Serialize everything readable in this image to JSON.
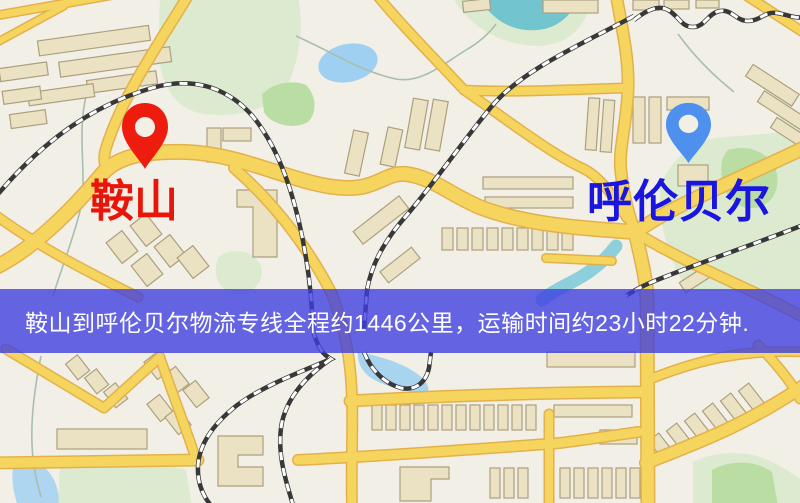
{
  "map": {
    "origin": {
      "name": "鞍山",
      "marker_color": "#ee1c0f",
      "label_color": "#e8150a"
    },
    "destination": {
      "name": "呼伦贝尔",
      "marker_color": "#4e90ee",
      "label_color": "#1a16e0"
    },
    "banner": {
      "text": "鞍山到呼伦贝尔物流专线全程约1446公里，运输时间约23小时22分钟.",
      "distance_text": "约1446公里",
      "duration_text": "约23小时22分钟",
      "background_color": "#3c3ce1",
      "background_opacity": 0.78,
      "text_color": "#ffffff"
    },
    "palette": {
      "background": "#f2efe7",
      "road": "#f6d55f",
      "road_casing": "#e3b14c",
      "railway": "#383838",
      "building": "#ebe2c4",
      "park": "#dcebd0",
      "water": "#a8d3f0"
    }
  }
}
